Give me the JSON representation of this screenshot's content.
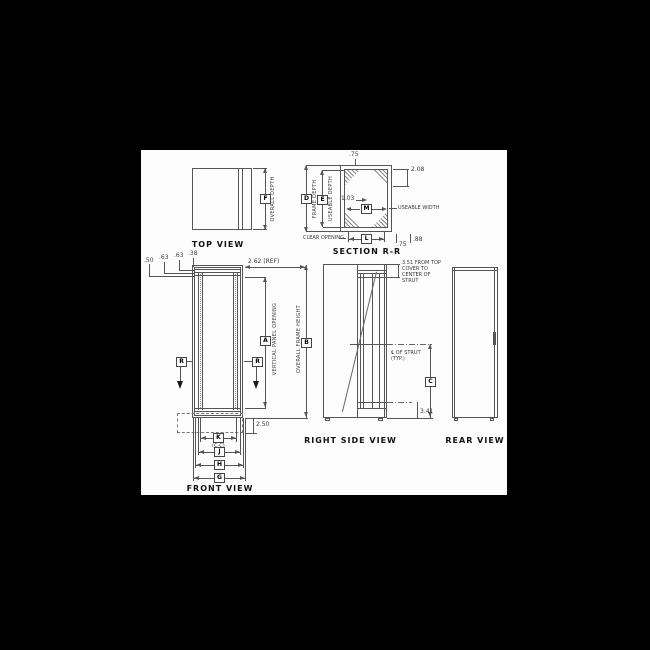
{
  "background": {
    "canvas": "#000000",
    "paper": "#fdfdfd",
    "line_color": "#555555"
  },
  "top_view": {
    "title": "TOP VIEW",
    "dim_f": "F",
    "label_overall_depth": "OVERALL DEPTH"
  },
  "section_rr": {
    "title": "SECTION R-R",
    "dim_d": "D",
    "label_frame_depth": "FRAME DEPTH",
    "dim_e": "E",
    "label_useable_depth": "USEABLE DEPTH",
    "dim_m": "M",
    "dim_l": "L",
    "label_useable_width": "USEABLE WIDTH",
    "label_clear_opening": "CLEAR OPENING",
    "val_top": ".75",
    "val_corner": "2.08",
    "val_gusset": "1.03",
    "val_bottom_inner": ".75",
    "val_bottom_outer": ".88"
  },
  "front_view": {
    "title": "FRONT VIEW",
    "val_1": ".50",
    "val_2": ".63",
    "val_3": ".63",
    "val_4": ".38",
    "val_ref": "2.62 (REF)",
    "dim_a": "A",
    "label_vertical_panel_opening": "VERTICAL PANEL OPENING",
    "dim_b": "B",
    "label_overall_frame_height": "OVERALL FRAME HEIGHT",
    "section_marker_left": "R",
    "section_marker_right": "R",
    "val_base": "2.50",
    "dim_k": "K",
    "note_k": "(C-C)",
    "dim_j": "J",
    "dim_h": "H",
    "dim_g": "G"
  },
  "right_side_view": {
    "title": "RIGHT SIDE VIEW",
    "note_top": "3.51 FROM TOP\nCOVER TO\nCENTER OF\nSTRUT",
    "note_strut": "℄ OF STRUT\n(TYP.)",
    "dim_c": "C",
    "val_bottom": "3.41"
  },
  "rear_view": {
    "title": "REAR VIEW"
  }
}
